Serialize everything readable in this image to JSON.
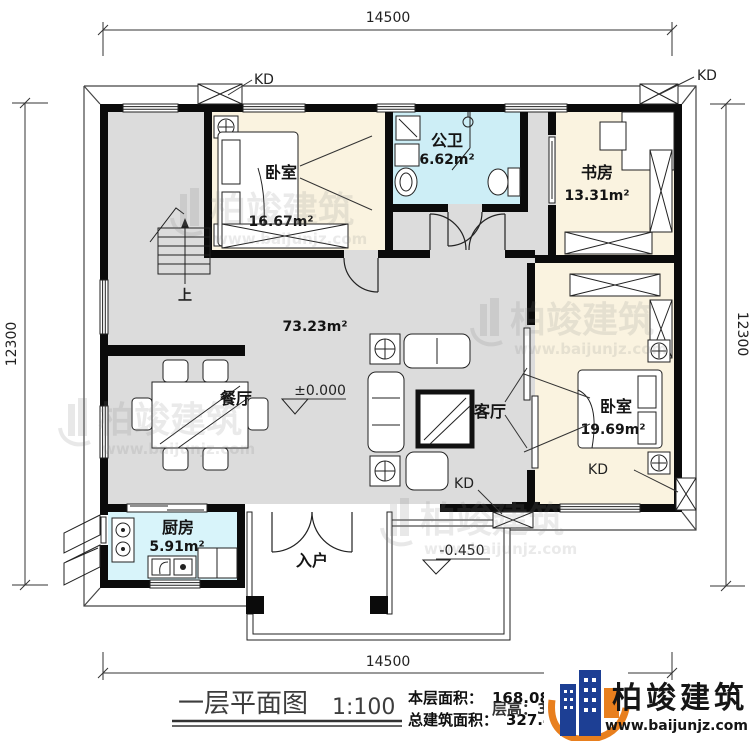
{
  "dimensions": {
    "top": "14500",
    "bottom": "14500",
    "left": "12300",
    "right": "12300"
  },
  "rooms": {
    "bedroom1": {
      "name": "卧室",
      "area": "16.67m²"
    },
    "bathroom": {
      "name": "公卫",
      "area": "6.62m²"
    },
    "study": {
      "name": "书房",
      "area": "13.31m²"
    },
    "open_area": {
      "area": "73.23m²"
    },
    "dining": {
      "name": "餐厅"
    },
    "living": {
      "name": "客厅"
    },
    "bedroom2": {
      "name": "卧室",
      "area": "19.69m²"
    },
    "kitchen": {
      "name": "厨房",
      "area": "5.91m²"
    },
    "entry": {
      "name": "入户"
    }
  },
  "annotations": {
    "kd": "KD",
    "stairs_up": "上",
    "level_main": "±0.000",
    "level_entry": "-0.450"
  },
  "title_block": {
    "title": "一层平面图",
    "scale": "1:100",
    "floor_area_label": "本层面积：",
    "floor_area_value": "168.08m²",
    "total_area_label": "总建筑面积：",
    "total_area_value": "327.46m²",
    "height_note": "层高：3.6米"
  },
  "brand": {
    "name": "柏竣建筑",
    "website": "www.baijunjz.com"
  },
  "watermark": {
    "name": "柏竣建筑",
    "website": "www.baijunjz.com"
  },
  "colors": {
    "wall": "#0b0b0b",
    "floor_gray": "#dcdcdc",
    "floor_cream": "#faf3e0",
    "floor_blue": "#cdeef6",
    "floor_cyan": "#d8f4fa",
    "brand_blue": "#1d3f94",
    "brand_orange": "#e87f1e"
  }
}
